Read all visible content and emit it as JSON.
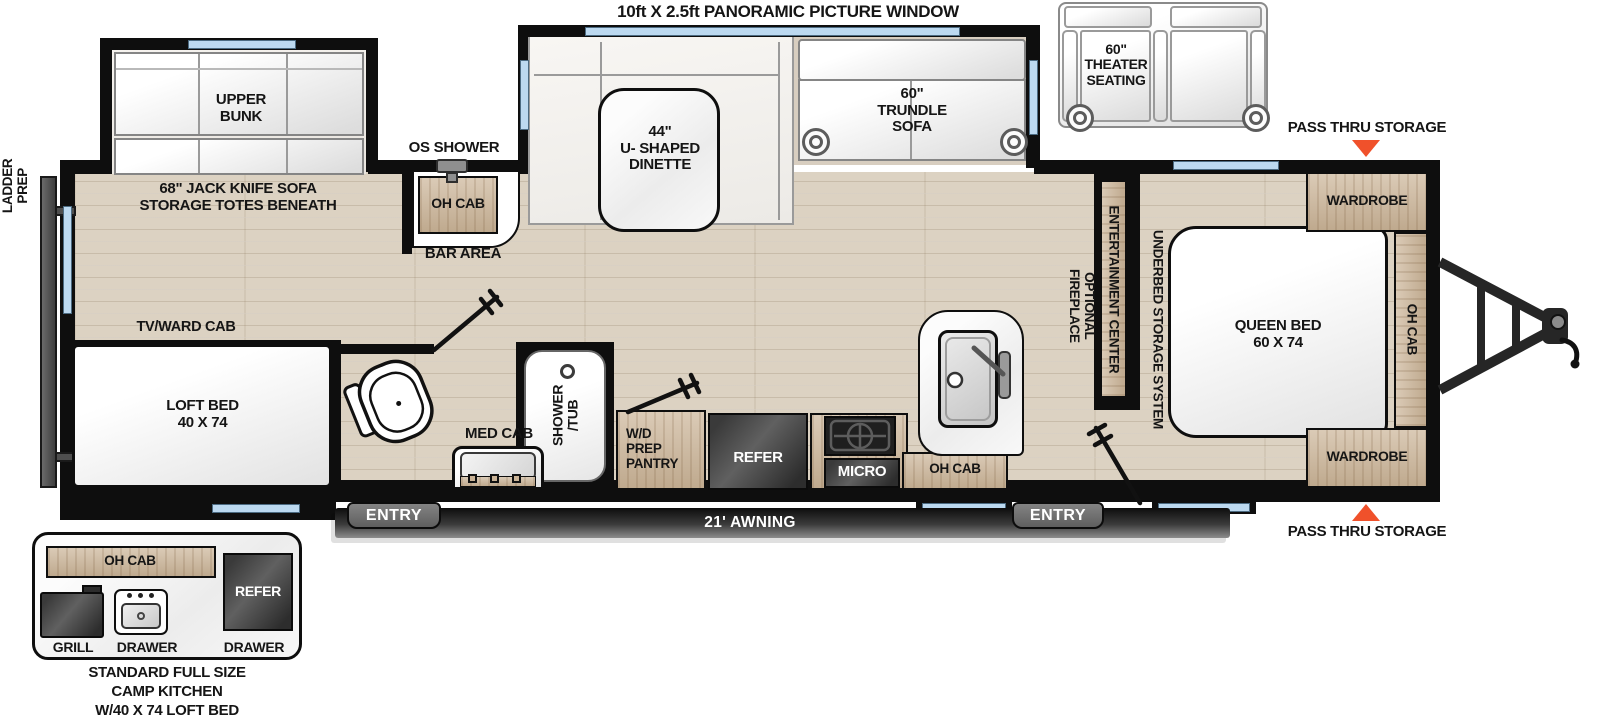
{
  "colors": {
    "accent_orange": "#F0512B",
    "window_blue": "#BCD9F0",
    "wall_black": "#0E0E0E",
    "cabinet_wood": "#CBB497",
    "appliance_dark": "#3A3A3A",
    "floor_tan": "#DCD2C2"
  },
  "header": {
    "panoramic_window": "10ft X 2.5ft PANORAMIC PICTURE WINDOW"
  },
  "exterior": {
    "ladder_prep": "LADDER\nPREP",
    "pass_thru_storage_top": "PASS THRU STORAGE",
    "pass_thru_storage_bottom": "PASS THRU STORAGE",
    "awning": "21' AWNING",
    "entry_bath": "ENTRY",
    "entry_bedroom": "ENTRY",
    "os_shower": "OS SHOWER"
  },
  "options": {
    "theater_seating": "60\"\nTHEATER\nSEATING"
  },
  "living": {
    "upper_bunk": "UPPER\nBUNK",
    "jack_knife_sofa": "68\" JACK KNIFE SOFA\nSTORAGE TOTES BENEATH",
    "dinette": "44\"\nU- SHAPED\nDINETTE",
    "trundle_sofa": "60\"\nTRUNDLE\nSOFA",
    "entertainment_center": "ENTERTAINMENT CENTER",
    "optional_fireplace": "OPTIONAL\nFIREPLACE",
    "tv_ward_cab": "TV/WARD CAB",
    "loft_bed": "LOFT BED\n40 X 74",
    "bar_oh_cab": "OH CAB",
    "bar_area": "BAR AREA"
  },
  "bath": {
    "med_cab": "MED CAB",
    "shower_tub": "SHOWER\n/TUB"
  },
  "kitchen": {
    "wd_prep_pantry": "W/D\nPREP\nPANTRY",
    "refer": "REFER",
    "micro": "MICRO",
    "oh_cab": "OH CAB"
  },
  "bedroom": {
    "queen_bed": "QUEEN BED\n60 X 74",
    "wardrobe_front": "WARDROBE",
    "wardrobe_rear": "WARDROBE",
    "underbed_storage": "UNDERBED STORAGE SYSTEM",
    "oh_cab": "OH CAB"
  },
  "camp_kitchen": {
    "oh_cab": "OH CAB",
    "refer": "REFER",
    "grill": "GRILL",
    "drawer_left": "DRAWER",
    "drawer_right": "DRAWER",
    "caption": "STANDARD FULL SIZE\nCAMP KITCHEN\nW/40 X 74 LOFT BED"
  }
}
